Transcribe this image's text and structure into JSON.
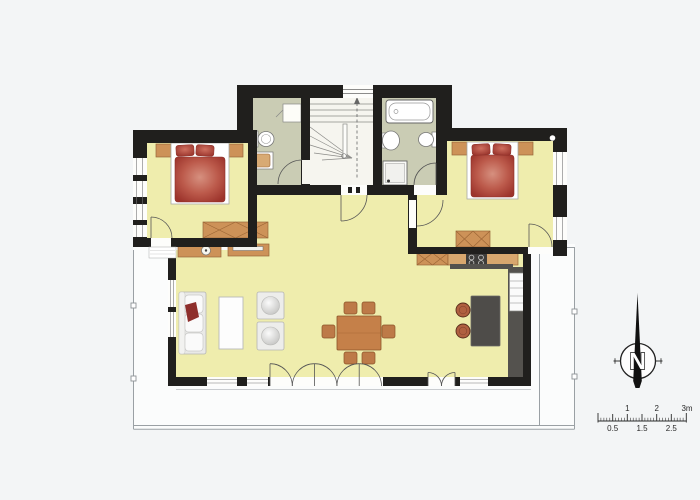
{
  "compass": {
    "label": "N"
  },
  "scale_bar": {
    "top_labels": [
      "1",
      "2",
      "3m"
    ],
    "bottom_labels": [
      "0.5",
      "1.5",
      "2.5"
    ]
  },
  "palette": {
    "background": "#f3f5f6",
    "wall_black": "#201f1d",
    "floor_yellow": "#efedad",
    "floor_bath_green": "#caccb4",
    "floor_hall_white": "#f6f5ef",
    "wood_tan": "#cd9258",
    "wood_outline": "#96663a",
    "kitchen_counter_dark": "#54524e",
    "bed_red": "#a43931",
    "bed_red_highlight": "#d6907f",
    "stool_brown": "#b06040",
    "terrace_line_grey": "#9aa0a4"
  },
  "fixtures": [
    "double-bed",
    "double-bed",
    "bathtub",
    "shower",
    "toilet",
    "toilet",
    "washbasin",
    "washbasin",
    "winder-staircase",
    "wardrobe",
    "dresser",
    "dresser",
    "sofa",
    "coffee-table",
    "armchair",
    "armchair",
    "dining-table-with-six-chairs",
    "sideboard",
    "tv-board",
    "kitchen-counter",
    "cooktop",
    "fridge-oven-column",
    "kitchen-island",
    "bar-stool",
    "bar-stool",
    "terrace",
    "north-compass",
    "scale-bar"
  ]
}
